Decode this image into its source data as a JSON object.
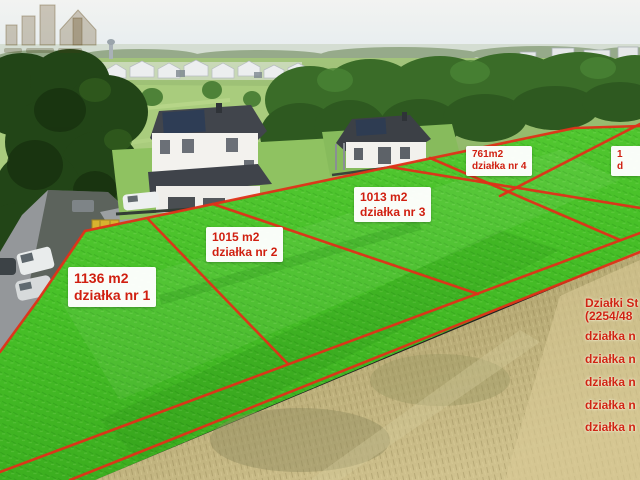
{
  "annotations": {
    "plots": [
      {
        "area": "1136 m2",
        "label": "działka nr 1"
      },
      {
        "area": "1015 m2",
        "label": "działka nr 2"
      },
      {
        "area": "1013 m2",
        "label": "działka nr 3"
      },
      {
        "area": "761m2",
        "label": "działka nr 4"
      },
      {
        "area": "1",
        "label": "d"
      }
    ]
  },
  "info_panel": {
    "title_line1": "Działki St",
    "title_line2": "(2254/48",
    "items": [
      "działka n",
      "działka n",
      "działka n",
      "działka n",
      "działka n"
    ]
  },
  "colors": {
    "boundary_red": "#e03018",
    "highlight_green": "#46bd27",
    "label_text": "#d01f10",
    "label_background": "#ffffff",
    "panel_text": "#cf2413"
  }
}
